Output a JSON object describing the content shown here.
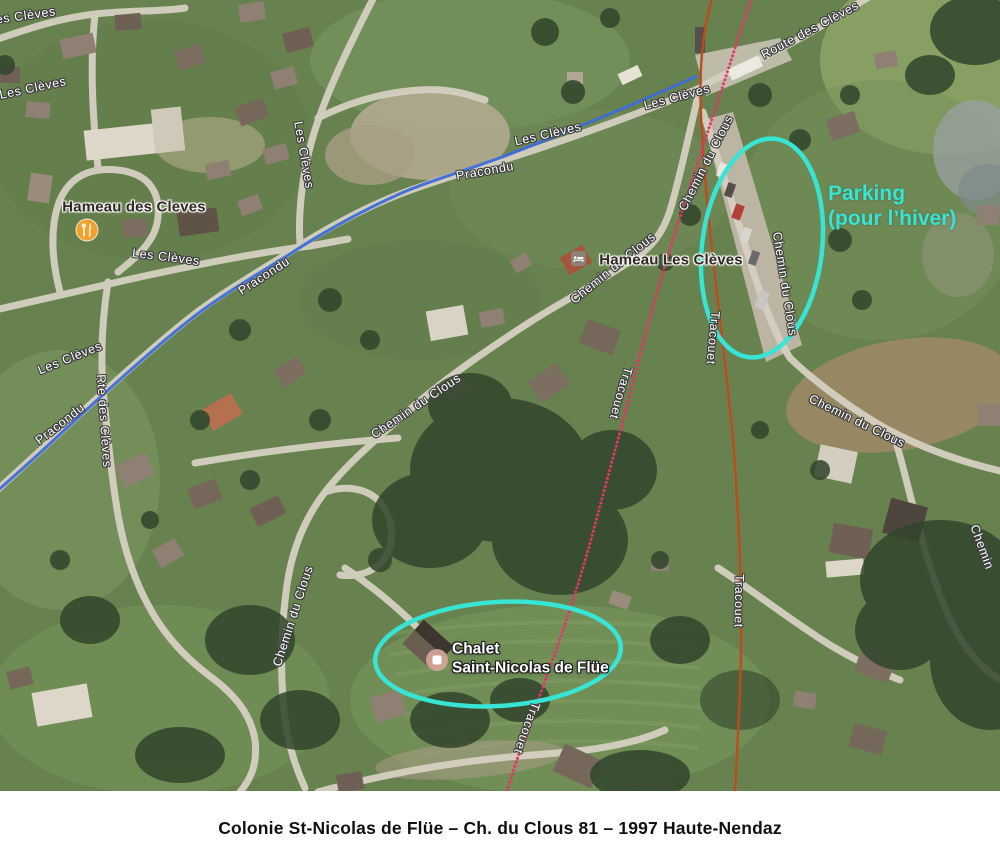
{
  "colors": {
    "annotation_cyan": "#38E4D4",
    "gps_route_blue": "#3E6CD8",
    "lift_line_orange": "#C04A20",
    "trail_dotted_pink": "#E8336A"
  },
  "map": {
    "road_labels": {
      "les_cleves": "Les Clèves",
      "route_des_cleves": "Route des Clèves",
      "rte_des_cleves": "Rte des Clèves",
      "pracondu": "Pracondu",
      "chemin_du_clous": "Chemin du Clous",
      "chemin": "Chemin",
      "tracouet": "Tracouet"
    },
    "pois": {
      "hameau_des_cleves": "Hameau des Cleves",
      "hameau_les_cleves": "Hameau Les Clèves",
      "chalet_line1": "Chalet",
      "chalet_line2": "Saint-Nicolas de Flüe"
    },
    "annotations": {
      "parking_line1": "Parking",
      "parking_line2": "(pour l’hiver)"
    }
  },
  "caption": "Colonie St-Nicolas de Flüe – Ch. du Clous 81 – 1997 Haute-Nendaz"
}
